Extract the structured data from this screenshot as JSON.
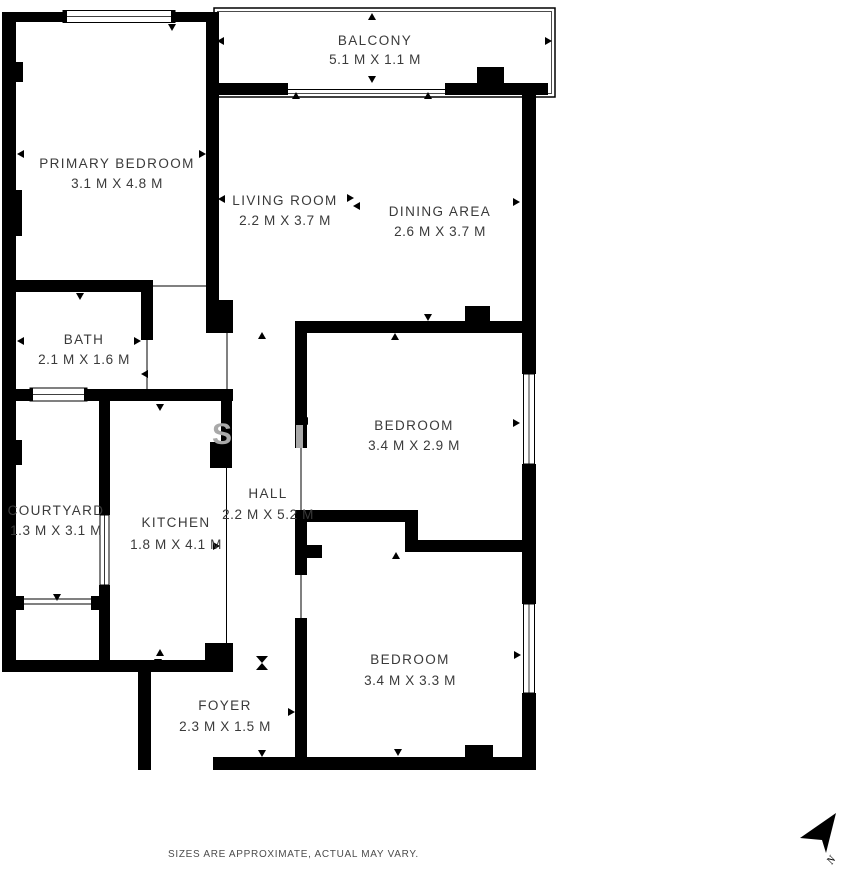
{
  "plan": {
    "rooms": [
      {
        "id": "balcony",
        "name": "BALCONY",
        "dims": "5.1 M X 1.1 M"
      },
      {
        "id": "primary-bedroom",
        "name": "PRIMARY BEDROOM",
        "dims": "3.1 M X 4.8 M"
      },
      {
        "id": "living-room",
        "name": "LIVING ROOM",
        "dims": "2.2 M X 3.7 M"
      },
      {
        "id": "dining-area",
        "name": "DINING AREA",
        "dims": "2.6 M X 3.7 M"
      },
      {
        "id": "bath",
        "name": "BATH",
        "dims": "2.1 M X 1.6 M"
      },
      {
        "id": "bedroom-middle",
        "name": "BEDROOM",
        "dims": "3.4 M X 2.9 M"
      },
      {
        "id": "courtyard",
        "name": "COURTYARD",
        "dims": "1.3 M X 3.1 M"
      },
      {
        "id": "kitchen",
        "name": "KITCHEN",
        "dims": "1.8 M X 4.1 M"
      },
      {
        "id": "hall",
        "name": "HALL",
        "dims": "2.2 M X 5.2 M"
      },
      {
        "id": "bedroom-bottom",
        "name": "BEDROOM",
        "dims": "3.4 M X 3.3 M"
      },
      {
        "id": "foyer",
        "name": "FOYER",
        "dims": "2.3 M X 1.5 M"
      }
    ],
    "footer": {
      "disclaimer": "SIZES ARE APPROXIMATE, ACTUAL MAY VARY."
    },
    "compass": {
      "label": "N"
    },
    "watermark": {
      "letter": "S"
    },
    "colors": {
      "wall": "#000000",
      "label_text": "#3a3a3a",
      "disclaimer_text": "#4c4c4c",
      "watermark": "#a9a9a9"
    }
  }
}
